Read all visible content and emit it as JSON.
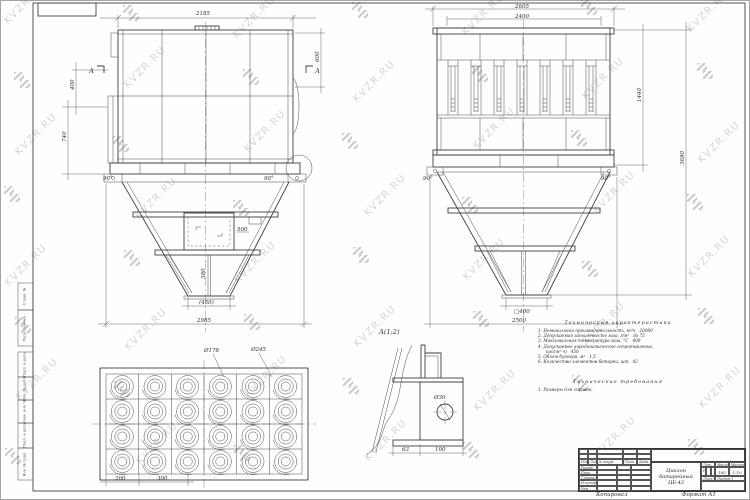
{
  "watermark": {
    "text": "KVZR.RU",
    "color": "#b3b3b3"
  },
  "colors": {
    "line": "#3f3f3f",
    "paper": "#ffffff"
  },
  "sheet": {
    "copied_label": "Копировал",
    "format_label": "Формат А1"
  },
  "views": {
    "front": {
      "section_label": "А",
      "dims": {
        "top": "2185",
        "inlet_height": "600",
        "left_upper": "400",
        "left_lower": "740",
        "hatch": "500",
        "rib": "380",
        "outlet": "(450)",
        "bottom": "2985",
        "angle_left": "90°",
        "angle_right": "90°"
      }
    },
    "side": {
      "dims": {
        "top_outer": "2605",
        "top_inner": "2400",
        "right_body": "1440",
        "right_total": "3680",
        "outlet": "□400",
        "bottom": "2500",
        "angle_left": "90°",
        "angle_right": "90°"
      }
    },
    "grid": {
      "dims": {
        "d_inner": "Ø178",
        "d_outer": "Ø245",
        "pitch_x": "200",
        "pitch_y": "300"
      }
    },
    "detail": {
      "title": "А(1:2)",
      "dims": {
        "hole": "Ø30",
        "offset": "63",
        "width": "100"
      }
    }
  },
  "tech_chars": {
    "title": "Техническая характеристика",
    "lines": [
      "1. Номинальная производительность, м³/ч   20000",
      "2. Допускаемая запыленность газа, г/м³   до 75",
      "3. Максимальная температура газа, °С   400",
      "4. Допускаемое аэродинамическое сопротивление,",
      "      кгс/(м²·ч)   450",
      "5. Объем бункера, м³   1,5",
      "6. Количество элементов батареи, шт   42"
    ]
  },
  "tech_reqs": {
    "title": "Технические требования",
    "lines": [
      "1. Размеры для справок."
    ]
  },
  "title_block": {
    "name_line1": "Циклон",
    "name_line2": "батарейный",
    "name_line3": "ЦБ-42",
    "cols": {
      "izm": "Изм.",
      "list": "Лист",
      "doc": "№ докум.",
      "sign": "Подп.",
      "date": "Дата"
    },
    "rows": [
      "Разраб.",
      "Пров.",
      "Т.контр.",
      "Н.контр.",
      "Утв."
    ],
    "lit_label": "Лит.",
    "mass_label": "Масса",
    "scale_label": "Масштаб",
    "lit_value": "у",
    "mass_value": "185",
    "scale_value": "1:10",
    "sheet_label": "Лист",
    "sheets_label": "Листов 1"
  },
  "side_stamps": [
    "Справ. №",
    "Перв. примен.",
    "Подп. и дата",
    "Инв. № дубл.",
    "Взам. инв. №",
    "Подп. и дата",
    "Инв. № подл."
  ]
}
